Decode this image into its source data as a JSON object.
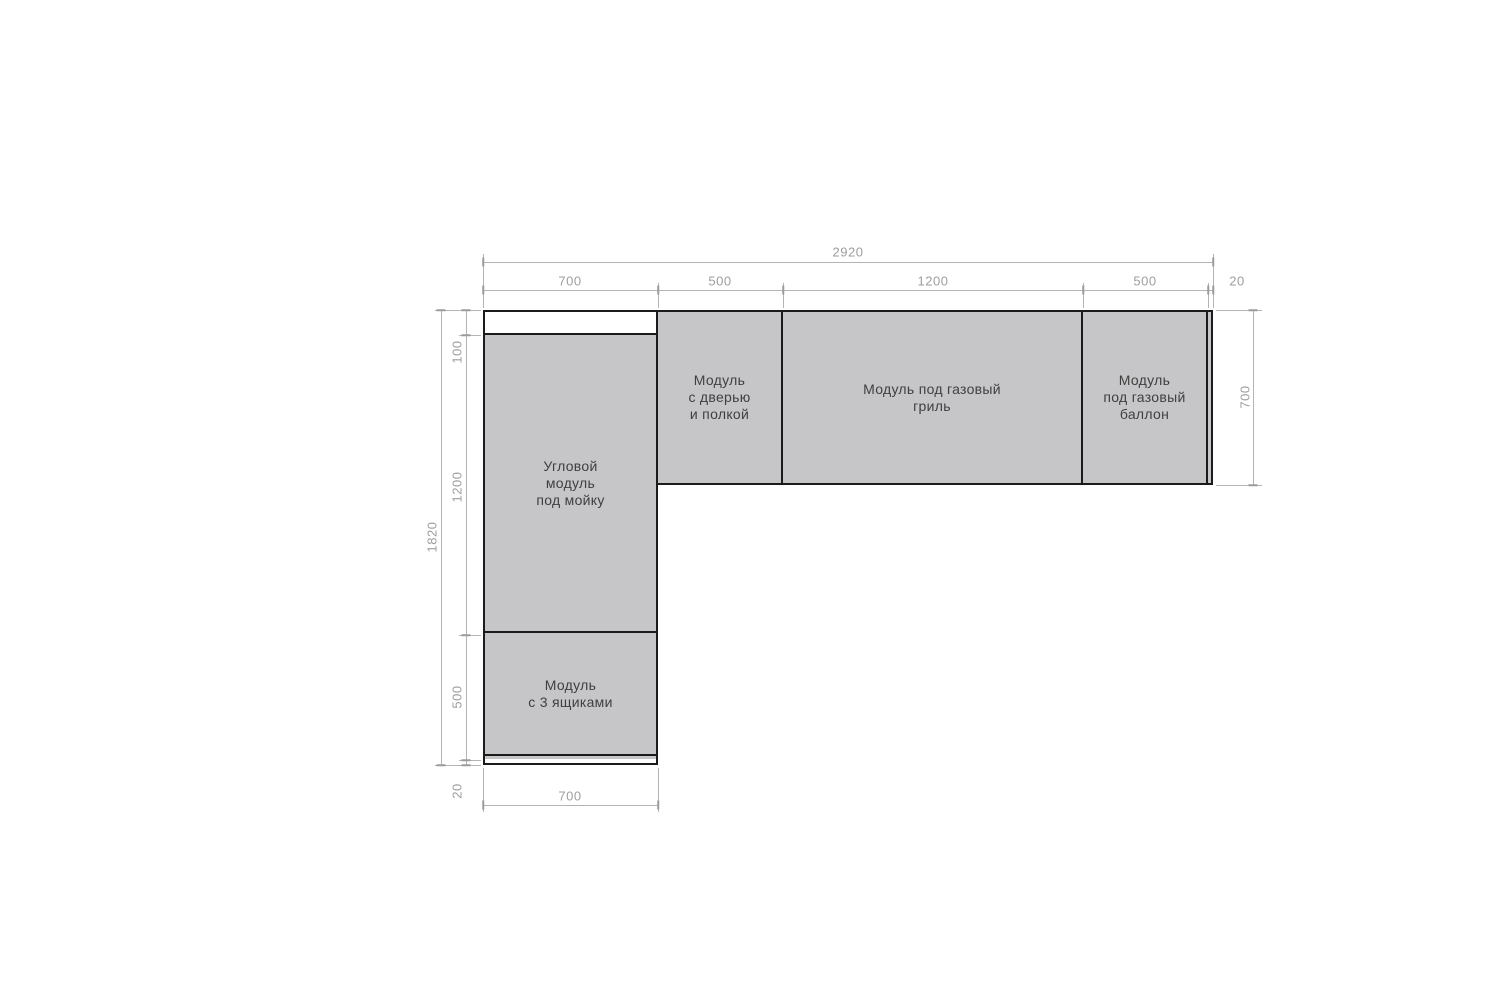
{
  "drawing": {
    "type": "furniture-layout-plan",
    "modules": {
      "corner_sink": {
        "label": "Угловой\nмодуль\nпод мойку"
      },
      "door_shelf": {
        "label": "Модуль\nс дверью\nи полкой"
      },
      "gas_grill": {
        "label": "Модуль под газовый\nгриль"
      },
      "gas_cylinder": {
        "label": "Модуль\nпод газовый\nбаллон"
      },
      "three_drawers": {
        "label": "Модуль\nс 3 ящиками"
      }
    },
    "dimensions": {
      "top_total": "2920",
      "top_segments": [
        "700",
        "500",
        "1200",
        "500",
        "20"
      ],
      "left_total": "1820",
      "left_segments": [
        "100",
        "1200",
        "500",
        "20"
      ],
      "right_side": "700",
      "bottom_width": "700"
    },
    "colors": {
      "module_fill": "#c6c6c8",
      "outline": "#1b1b1b",
      "dim_line": "#b4b4b4",
      "dim_text": "#9e9e9e",
      "label_text": "#3f3f3f"
    }
  }
}
